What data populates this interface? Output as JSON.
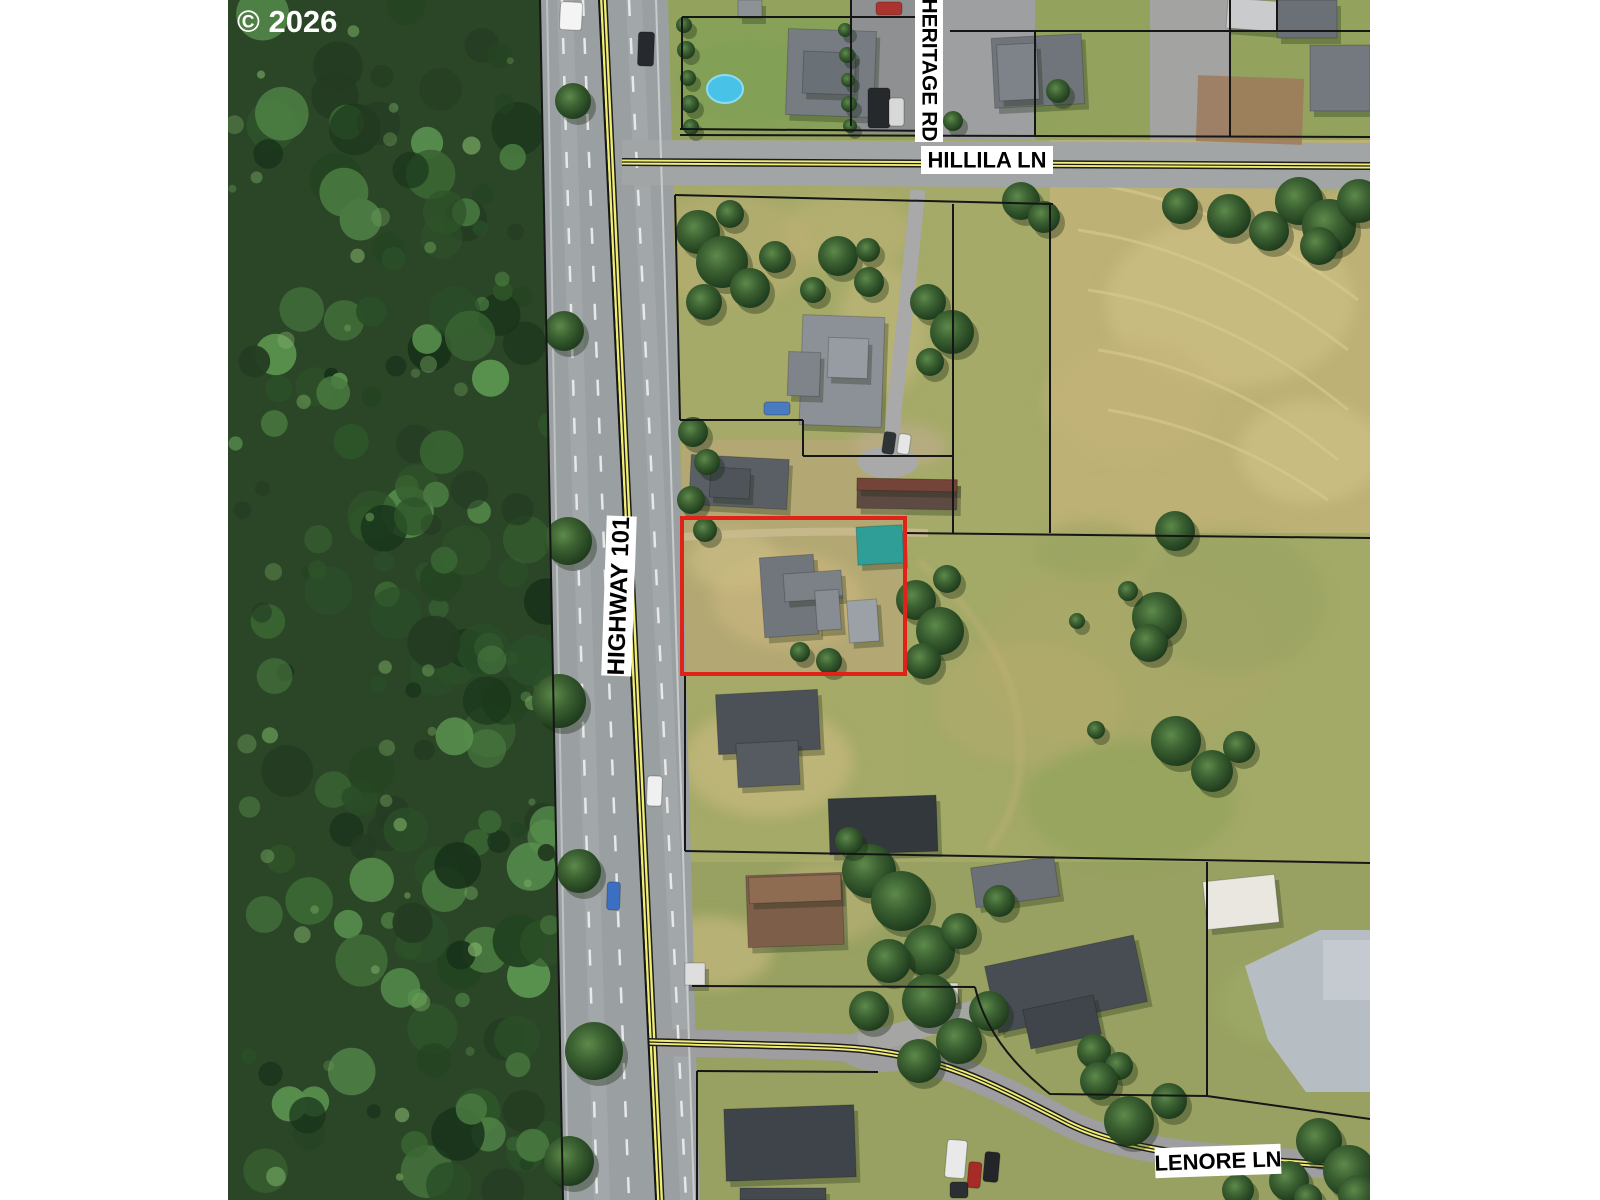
{
  "map": {
    "copyright_text": "© 2026",
    "road_labels": {
      "highway101": "HIGHWAY 101",
      "heritage_rd": "HERITAGE RD",
      "hillila_ln": "HILLILA LN",
      "lenore_ln": "LENORE LN"
    },
    "colors": {
      "parcel_boundary": "#161616",
      "highlighted_parcel": "#e02318",
      "road_centerline_yellow": "#f0ed74",
      "label_background": "#ffffff",
      "label_text": "#000000"
    }
  }
}
